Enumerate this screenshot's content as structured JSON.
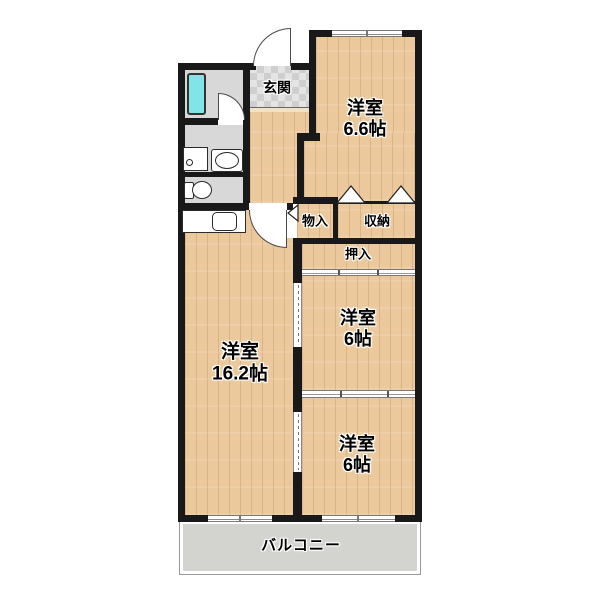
{
  "fp": {
    "entrance": {
      "label": "玄関"
    },
    "room66": {
      "name": "洋室",
      "size": "6.6帖"
    },
    "monoire": {
      "label": "物入"
    },
    "shunou": {
      "label": "収納"
    },
    "oshiire": {
      "label": "押入"
    },
    "main_room": {
      "name": "洋室",
      "size": "16.2帖"
    },
    "mid_room": {
      "name": "洋室",
      "size": "6帖"
    },
    "bottom_room": {
      "name": "洋室",
      "size": "6帖"
    },
    "balcony": {
      "label": "バルコニー"
    },
    "colors": {
      "wall": "#191919",
      "wood_floor": "#ebc99c",
      "wet_area_gray": "#d8d8d8",
      "bathtub_cyan": "#7fe5e7",
      "balcony_gray": "#d3d3cf",
      "entrance_tile": "#d4d4d4"
    },
    "fixtures": [
      "bathtub",
      "bathroom-door",
      "entrance-door",
      "washing-machine-pan",
      "vanity-sink",
      "toilet",
      "kitchen-counter-sink",
      "living-room-door",
      "bifold-closet-doors",
      "sliding-doors",
      "balcony-windows"
    ]
  }
}
